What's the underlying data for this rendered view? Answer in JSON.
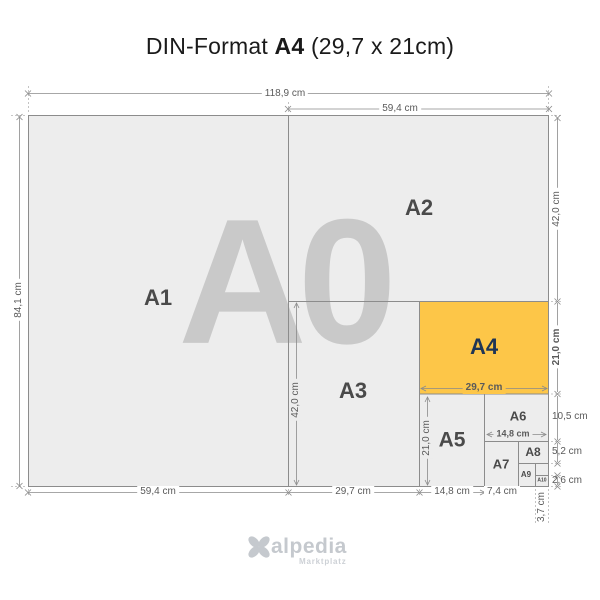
{
  "title": {
    "prefix": "DIN-Format",
    "bold": "A4",
    "suffix": "(29,7 x 21cm)"
  },
  "watermark": "A0",
  "formats": {
    "a1": "A1",
    "a2": "A2",
    "a3": "A3",
    "a4": "A4",
    "a5": "A5",
    "a6": "A6",
    "a7": "A7",
    "a8": "A8",
    "a9": "A9",
    "a10": "A10"
  },
  "dims": {
    "total_width": "118,9 cm",
    "half_width_top": "59,4 cm",
    "total_height": "84,1 cm",
    "a2_height": "42,0 cm",
    "a4_height": "21,0 cm",
    "a6_height": "10,5 cm",
    "a8_height": "5,2 cm",
    "a10_height": "2,6 cm",
    "a1_width": "59,4 cm",
    "a3_width_bottom": "29,7 cm",
    "a5_width_bottom": "14,8 cm",
    "a7_width": "7,4 cm",
    "a9_width": "3,7 cm",
    "a3_height_inner": "42,0 cm",
    "a5_height_inner": "21,0 cm",
    "a4_width_inner": "29,7 cm",
    "a6_width_inner": "14,8 cm"
  },
  "logo": {
    "name": "alpedia",
    "tagline": "Marktplatz"
  },
  "colors": {
    "highlight": "#FDC648",
    "paper": "#EDEDED",
    "border": "#8C8C8C",
    "navy": "#1F3555",
    "label": "#4A4A4A",
    "dim_text": "#5A5A5A",
    "watermark": "#C9C9C9"
  }
}
